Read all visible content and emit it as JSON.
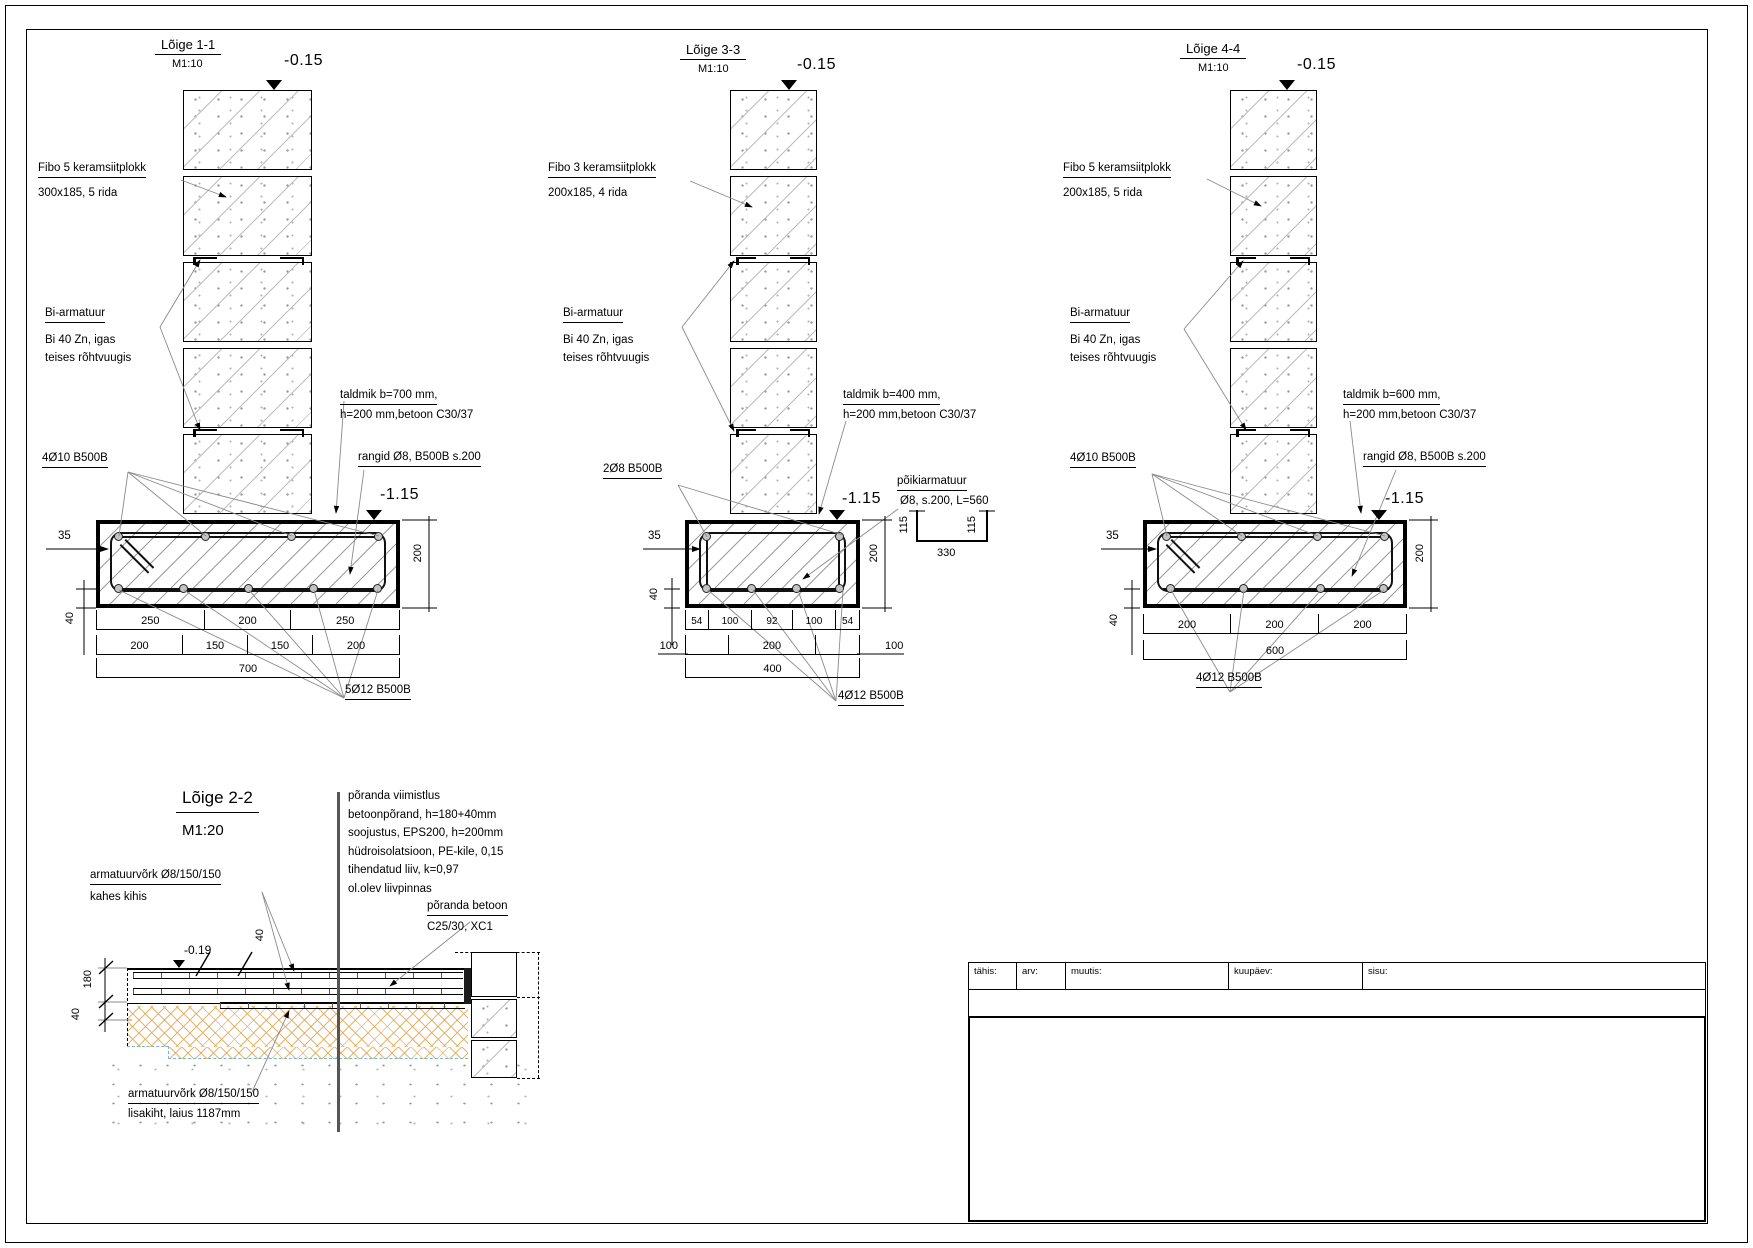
{
  "s1": {
    "title": "Lõige 1-1",
    "scale_label": "M1:10",
    "level_top": "-0.15",
    "level_bottom": "-1.15",
    "fibo_line1": "Fibo 5 keramsiitplokk",
    "fibo_line2": "300x185, 5 rida",
    "bi_line1": "Bi-armatuur",
    "bi_line2": "Bi 40 Zn, igas",
    "bi_line3": "teises rõhtvuugis",
    "top_bars_label": "4Ø10 B500B",
    "taldmik_line1": "taldmik b=700 mm,",
    "taldmik_line2": "h=200 mm,betoon C30/37",
    "rangid_label": "rangid Ø8, B500B s.200",
    "bottom_bars_label": "5Ø12 B500B",
    "dim_side": "35",
    "dim_height": "200",
    "dim_cover": "40",
    "row1": [
      "250",
      "200",
      "250"
    ],
    "row2": [
      "200",
      "150",
      "150",
      "200"
    ],
    "total": "700"
  },
  "s3": {
    "title": "Lõige 3-3",
    "scale_label": "M1:10",
    "level_top": "-0.15",
    "level_bottom": "-1.15",
    "fibo_line1": "Fibo 3 keramsiitplokk",
    "fibo_line2": "200x185, 4 rida",
    "bi_line1": "Bi-armatuur",
    "bi_line2": "Bi 40 Zn, igas",
    "bi_line3": "teises rõhtvuugis",
    "top_bars_label": "2Ø8 B500B",
    "taldmik_line1": "taldmik b=400 mm,",
    "taldmik_line2": "h=200 mm,betoon C30/37",
    "poiki_line1": "põikiarmatuur",
    "poiki_line2": "Ø8, s.200, L=560",
    "bottom_bars_label": "4Ø12 B500B",
    "dim_side": "35",
    "dim_height": "200",
    "dim_cover": "40",
    "row1": [
      "54",
      "100",
      "92",
      "100",
      "54"
    ],
    "row2": [
      "100",
      "200",
      "100"
    ],
    "total": "400",
    "channel": {
      "left": "115",
      "mid": "330",
      "right": "115"
    }
  },
  "s4": {
    "title": "Lõige 4-4",
    "scale_label": "M1:10",
    "level_top": "-0.15",
    "level_bottom": "-1.15",
    "fibo_line1": "Fibo 5 keramsiitplokk",
    "fibo_line2": "200x185, 5 rida",
    "bi_line1": "Bi-armatuur",
    "bi_line2": "Bi 40 Zn, igas",
    "bi_line3": "teises rõhtvuugis",
    "top_bars_label": "4Ø10 B500B",
    "taldmik_line1": "taldmik b=600 mm,",
    "taldmik_line2": "h=200 mm,betoon C30/37",
    "rangid_label": "rangid Ø8, B500B s.200",
    "bottom_bars_label": "4Ø12 B500B",
    "dim_side": "35",
    "dim_height": "200",
    "dim_cover": "40",
    "row1": [
      "200",
      "200",
      "200"
    ],
    "total": "600"
  },
  "s2": {
    "title": "Lõige 2-2",
    "scale_label": "M1:20",
    "layers": [
      "põranda viimistlus",
      "betoonpõrand, h=180+40mm",
      "soojustus, EPS200, h=200mm",
      "hüdroisolatsioon, PE-kile, 0,15",
      "tihendatud liiv, k=0,97",
      "ol.olev liivpinnas"
    ],
    "mesh_line1": "armatuurvõrk Ø8/150/150",
    "mesh_line2": "kahes kihis",
    "concrete_line1": "põranda betoon",
    "concrete_line2": "C25/30, XC1",
    "level": "-0.19",
    "dim_topping": "40",
    "dim_slab": "180",
    "dim_extra": "40",
    "mesh2_line1": "armatuurvõrk Ø8/150/150",
    "mesh2_line2": "lisakiht, laius 1187mm"
  },
  "titleblock": {
    "col1": "tähis:",
    "col2": "arv:",
    "col3": "muutis:",
    "col4": "kuupäev:",
    "col5": "sisu:"
  },
  "colors": {
    "insulation_hatch": "#e4a850",
    "hydro_dashed": "#7fb2d6",
    "concrete_hatch": "#9c9c9c",
    "leader_line": "#8a8a8a"
  }
}
